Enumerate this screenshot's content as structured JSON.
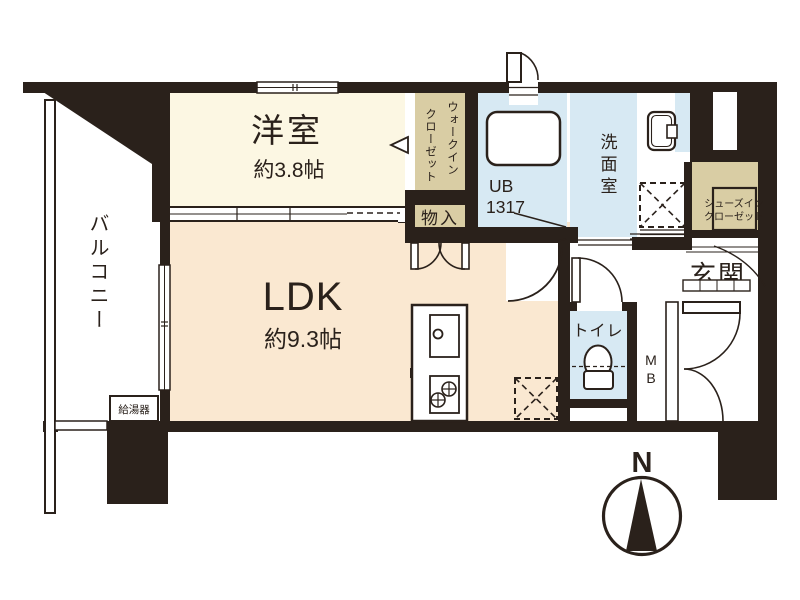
{
  "plan_title": "apartment-floor-plan",
  "rooms": {
    "balcony": {
      "label": "バルコニー"
    },
    "water_heater": {
      "label": "給湯器"
    },
    "western_room": {
      "label": "洋室",
      "size": "約3.8帖"
    },
    "ldk": {
      "label": "LDK",
      "size": "約9.3帖"
    },
    "walk_in_closet": {
      "line1": "ウォークイン",
      "line2": "クローゼット"
    },
    "storage": {
      "label": "物入"
    },
    "unit_bath": {
      "line1": "UB",
      "line2": "1317"
    },
    "washroom": {
      "label": "洗面室"
    },
    "toilet": {
      "label": "トイレ"
    },
    "shoes_closet": {
      "line1": "シューズイン",
      "line2": "クローゼット"
    },
    "entrance": {
      "label": "玄関"
    },
    "meter_box": {
      "label": "MB"
    }
  },
  "compass": {
    "label": "N"
  },
  "colors": {
    "wall": "#2A211B",
    "room_cream": "#FCF7E3",
    "room_peach": "#FAE8D1",
    "closet_tan": "#D9CDA4",
    "wet_area_blue": "#D7E9F3",
    "white": "#FFFFFF"
  }
}
